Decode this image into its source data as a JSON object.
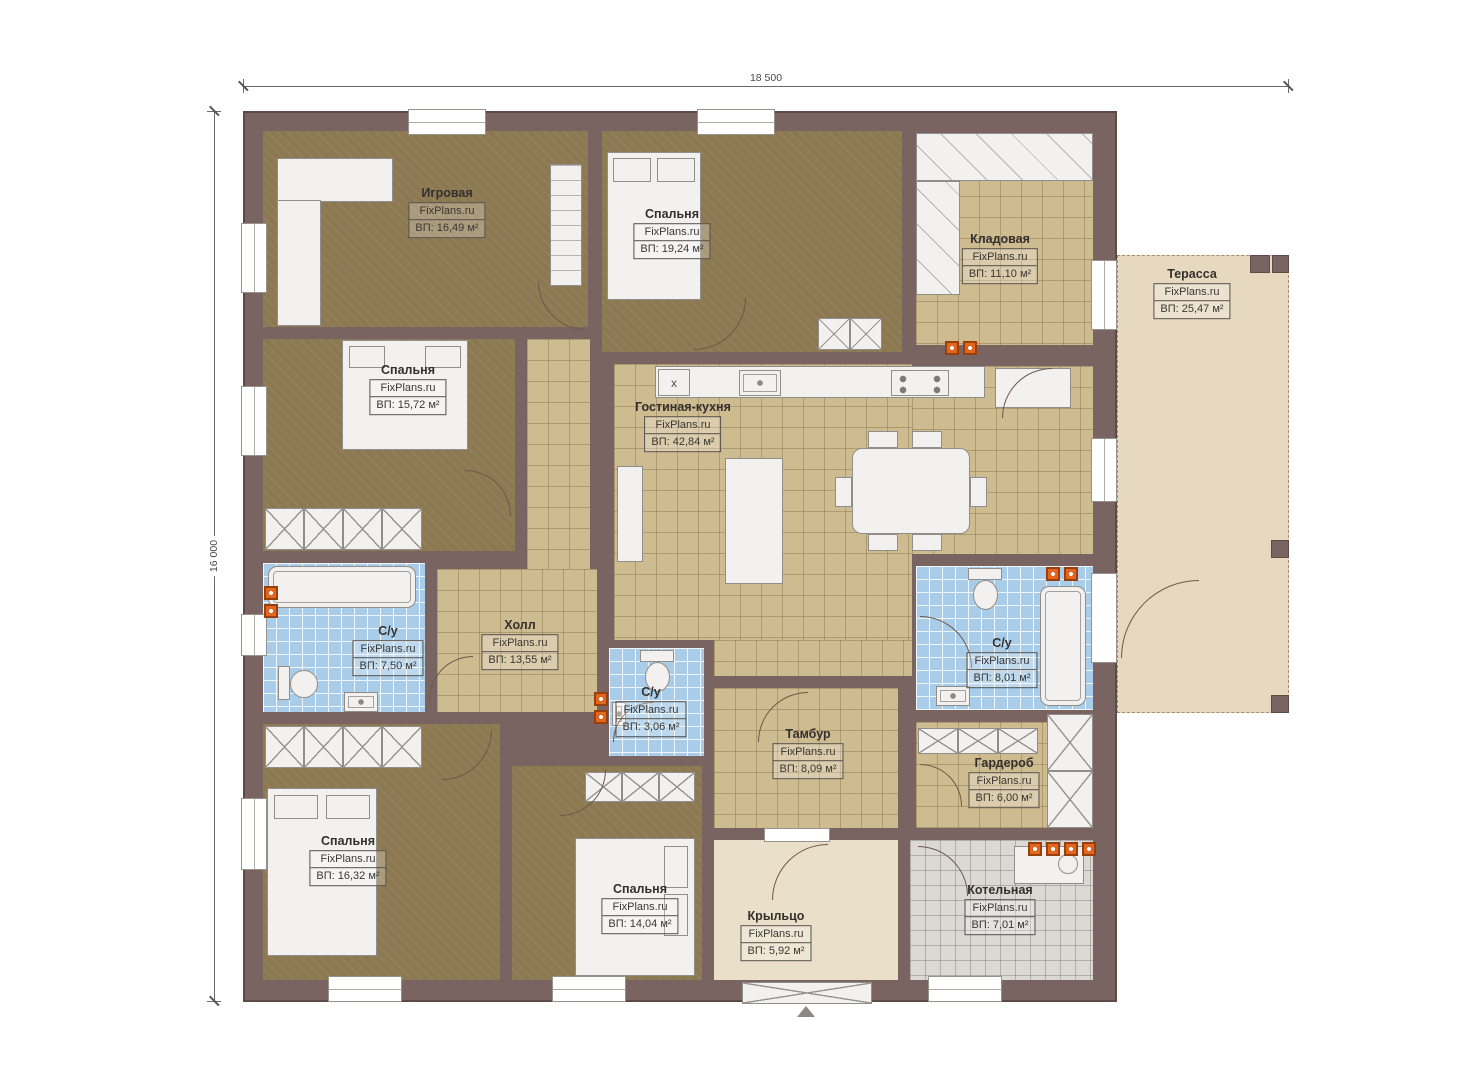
{
  "branding": "FixPlans.ru",
  "dimensions": {
    "width": "18 500",
    "height": "16 000"
  },
  "kitchen_mark": "x",
  "colors": {
    "wall": "#7a6461",
    "room_dark": "#8c7851",
    "room_tile": "#cebb90",
    "room_wet": "#a9cde9",
    "room_service": "#dcd9d4",
    "terrace": "#e6d9c0",
    "porch": "#eadfc8",
    "fixture": "#f2f1ef",
    "vent_accent": "#e2661f"
  },
  "rooms": [
    {
      "id": "igrovaya",
      "name": "Игровая",
      "area": "ВП: 16,49 м²"
    },
    {
      "id": "spalnya-19",
      "name": "Спальня",
      "area": "ВП: 19,24 м²"
    },
    {
      "id": "kladovaya",
      "name": "Кладовая",
      "area": "ВП: 11,10 м²"
    },
    {
      "id": "terrasa",
      "name": "Терасса",
      "area": "ВП: 25,47 м²"
    },
    {
      "id": "spalnya-15",
      "name": "Спальня",
      "area": "ВП: 15,72 м²"
    },
    {
      "id": "gostinaya",
      "name": "Гостиная-кухня",
      "area": "ВП: 42,84 м²"
    },
    {
      "id": "kholl",
      "name": "Холл",
      "area": "ВП: 13,55 м²"
    },
    {
      "id": "su-7",
      "name": "С/у",
      "area": "ВП: 7,50 м²"
    },
    {
      "id": "su-3",
      "name": "С/у",
      "area": "ВП: 3,06 м²"
    },
    {
      "id": "tambur",
      "name": "Тамбур",
      "area": "ВП: 8,09 м²"
    },
    {
      "id": "su-8",
      "name": "С/у",
      "area": "ВП: 8,01 м²"
    },
    {
      "id": "garderob",
      "name": "Гардероб",
      "area": "ВП: 6,00 м²"
    },
    {
      "id": "spalnya-16",
      "name": "Спальня",
      "area": "ВП: 16,32 м²"
    },
    {
      "id": "spalnya-14",
      "name": "Спальня",
      "area": "ВП: 14,04 м²"
    },
    {
      "id": "kryltso",
      "name": "Крыльцо",
      "area": "ВП: 5,92 м²"
    },
    {
      "id": "kotelnaya",
      "name": "Котельная",
      "area": "ВП: 7,01 м²"
    }
  ]
}
